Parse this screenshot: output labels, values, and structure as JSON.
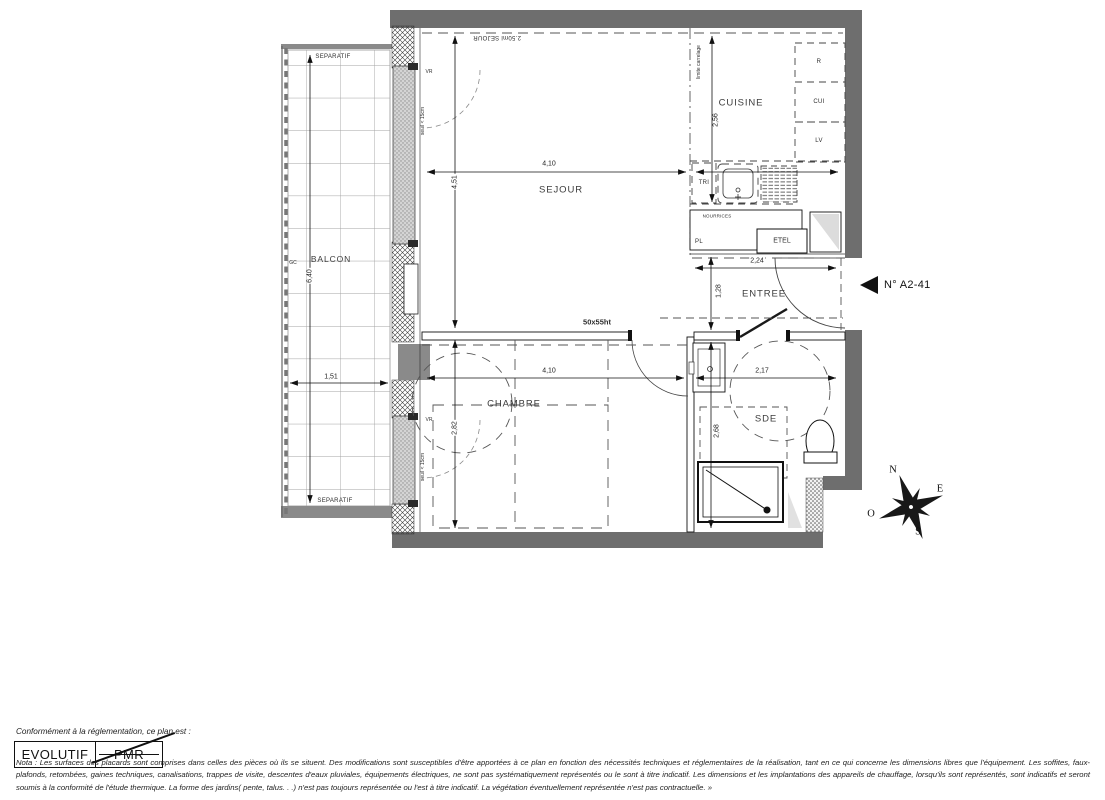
{
  "unit": {
    "number": "N° A2-41"
  },
  "rooms": {
    "sejour": "SEJOUR",
    "cuisine": "CUISINE",
    "entree": "ENTREE",
    "chambre": "CHAMBRE",
    "sde": "SDE",
    "balcon": "BALCON"
  },
  "dims": {
    "sejour_w": "4,10",
    "sejour_h": "4,51",
    "cuisine_h": "2,56",
    "entree_w": "2,24",
    "entree_h": "1,28",
    "sde_w": "2,17",
    "sde_h": "2,68",
    "chambre_w": "4,10",
    "chambre_h": "2,82",
    "balcon_w": "1,51",
    "balcon_h": "6,40"
  },
  "annot": {
    "separatif_top": "SEPARATIF",
    "separatif_bottom": "SEPARATIF",
    "gc": "GC",
    "bay_sejour": "2.50ml SEJOUR",
    "vr_sejour": "VR",
    "seuil_sejour": "seuil < 15cm",
    "vr_chambre": "VR",
    "seuil_chambre": "seuil < 15cm",
    "limite_carrelage": "limite carrelage",
    "tri": "TRI",
    "nourrices": "NOURRICES",
    "pl": "PL",
    "etel": "ETEL",
    "frigo": "R",
    "cuisson": "CUI",
    "lave_vaisselle": "LV",
    "cloison": "50x55ht"
  },
  "compass": {
    "north": "N",
    "east": "E",
    "west": "O",
    "south": "S"
  },
  "footer": {
    "conformity": "Conformément à la réglementation, ce plan est :",
    "evolutif": "EVOLUTIF",
    "pmr": "PMR",
    "nota": "Nota : Les surfaces des placards sont comprises dans celles des pièces où ils se situent. Des modifications sont susceptibles d'être apportées à ce plan en fonction des nécessités techniques et réglementaires de la réalisation, tant en ce qui concerne les dimensions libres que l'équipement.  Les soffites, faux-plafonds, retombées, gaines techniques, canalisations, trappes de visite, descentes d'eaux pluviales, équipements électriques, ne sont pas systématiquement représentés ou le sont à titre indicatif. Les dimensions et les implantations des appareils de chauffage, lorsqu'ils sont représentés, sont indicatifs et seront soumis à la conformité de l'étude thermique. La forme des jardins( pente, talus. . .) n'est pas toujours représentée ou l'est à titre indicatif. La végétation éventuellement représentée n'est pas contractuelle. »"
  },
  "colors": {
    "wall_gray": "#6e6e6e",
    "line_black": "#1a1a1a",
    "dash_gray": "#555555"
  }
}
